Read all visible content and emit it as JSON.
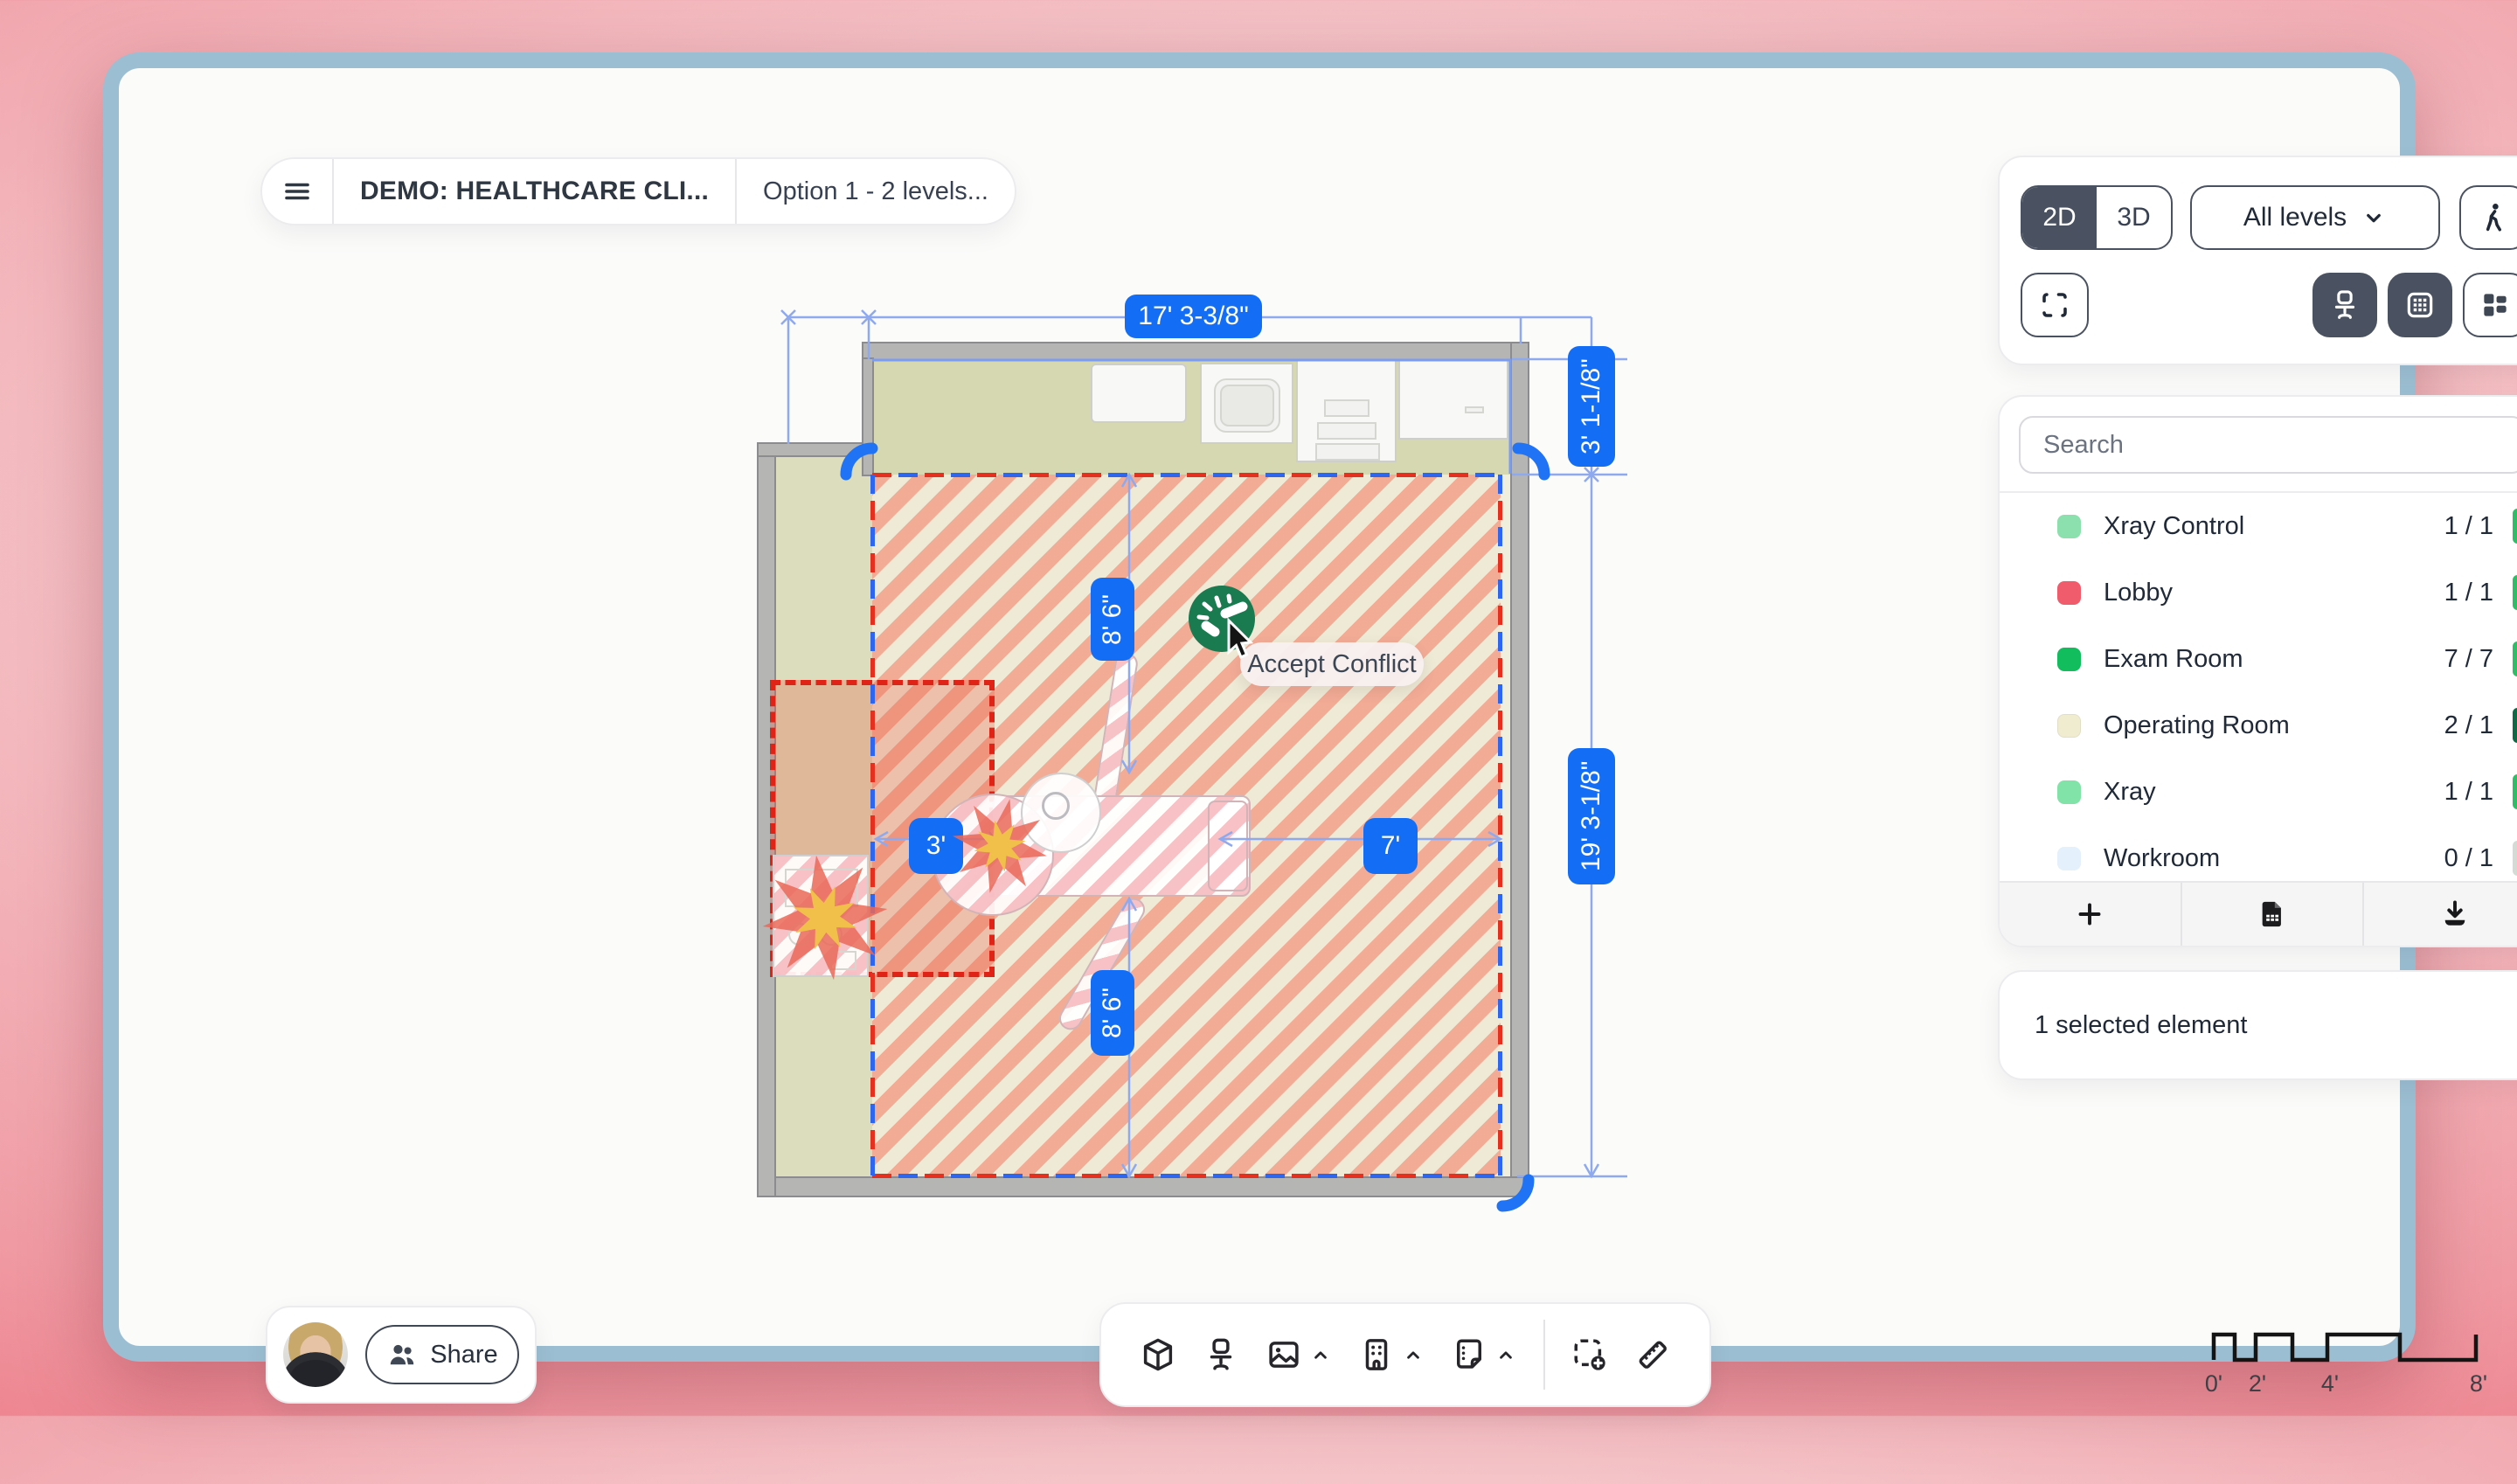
{
  "header": {
    "project_title": "DEMO: HEALTHCARE CLI...",
    "option_label": "Option 1 - 2 levels..."
  },
  "view_controls": {
    "mode_2d": "2D",
    "mode_3d": "3D",
    "active_mode": "2D",
    "levels_label": "All levels",
    "icons": [
      "walk-icon",
      "fullscreen-icon",
      "office-chair-icon",
      "grid-icon",
      "layout-icon",
      "chevron-down-icon"
    ]
  },
  "layers_panel": {
    "search_placeholder": "Search",
    "items": [
      {
        "label": "Xray Control",
        "count": "1 / 1",
        "swatch": "#8ce0ad",
        "bar": "#2ebe66"
      },
      {
        "label": "Lobby",
        "count": "1 / 1",
        "swatch": "#f05c6b",
        "bar": "#2ebe66"
      },
      {
        "label": "Exam Room",
        "count": "7 / 7",
        "swatch": "#12bd5e",
        "bar": "#2ebe66"
      },
      {
        "label": "Operating Room",
        "count": "2 / 1",
        "swatch": "#efeccf",
        "bar": "#0d6a45"
      },
      {
        "label": "Xray",
        "count": "1 / 1",
        "swatch": "#82e3a8",
        "bar": "#2ebe66"
      },
      {
        "label": "Workroom",
        "count": "0 / 1",
        "swatch": "#e4f0fb",
        "bar": "#d4dbd4"
      }
    ],
    "footer_icons": [
      "plus-icon",
      "file-spreadsheet-icon",
      "download-icon"
    ]
  },
  "selection": {
    "text": "1 selected element"
  },
  "share": {
    "label": "Share"
  },
  "toolbar": {
    "icons": [
      "cube-3d-icon",
      "office-chair-icon",
      "image-icon",
      "building-icon",
      "note-icon",
      "select-add-icon",
      "ruler-icon"
    ]
  },
  "plan": {
    "dim_width": "17' 3-3/8\"",
    "dim_offset_right": "3' 1-1/8\"",
    "dim_height_right": "19' 3-1/8\"",
    "dim_interior_top": "8' 6\"",
    "dim_interior_bottom": "8' 6\"",
    "dim_clearance_left": "3'",
    "dim_clearance_right": "7'",
    "conflict_tooltip": "Accept Conflict",
    "accent_blue": "#146ef5",
    "conflict_green": "#1a7a50",
    "stripe_salmon": "#f3a58f",
    "stripe_cream": "#eeead6"
  },
  "scale_bar": {
    "labels": [
      "0'",
      "2'",
      "4'",
      "8'"
    ]
  }
}
